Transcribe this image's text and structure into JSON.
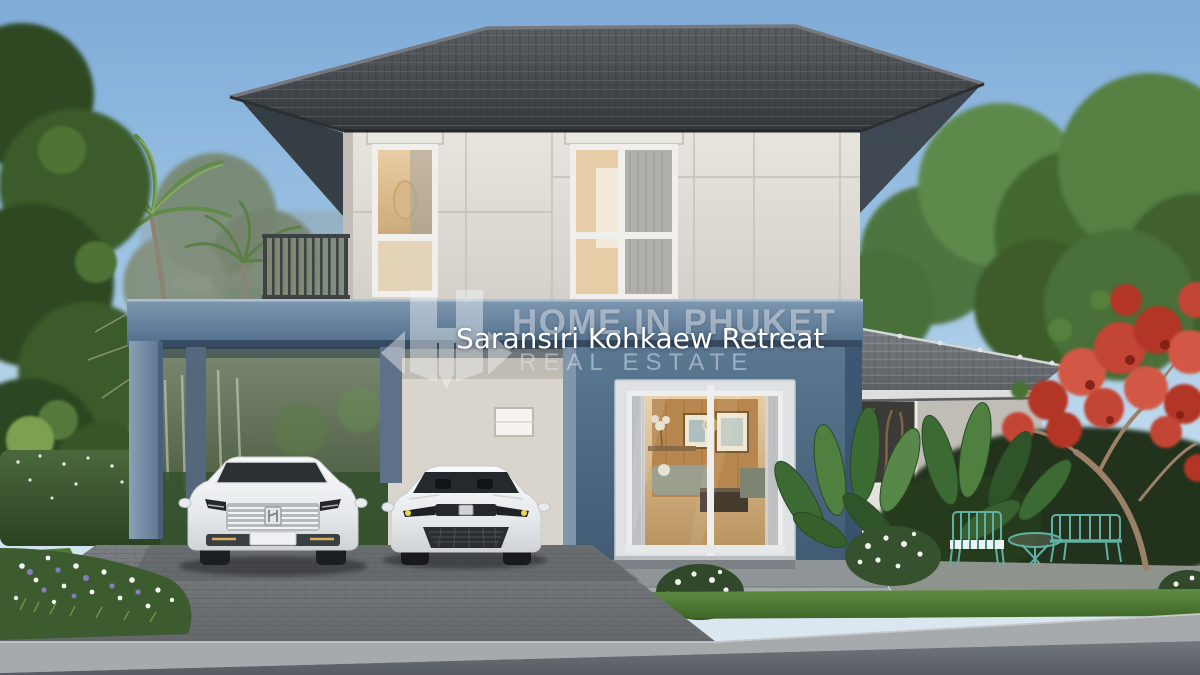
{
  "scene": {
    "type": "real-estate-architectural-render",
    "caption": "Saransiri Kohkaew Retreat",
    "watermark": {
      "logo_icon": "h-arrows-logo",
      "line1": "HOME IN PHUKET",
      "line2": "REAL ESTATE"
    },
    "palette": {
      "sky_top": "#7fabd8",
      "sky_horizon": "#dfe9f0",
      "roof_dark": "#3a3e42",
      "wing_roof_gray": "#6e7377",
      "wall_cream": "#d9d4cc",
      "accent_slate_blue": "#6d87a2",
      "living_wall_blue": "#4c6783",
      "glass_interior_warm": "#caa36f",
      "foliage_green": "#4a6b3a",
      "flame_tree_red": "#c2402f",
      "furniture_teal": "#5fb0a5",
      "driveway_gray": "#6e7275",
      "road_gray": "#676d73",
      "car_white": "#eef0f2"
    }
  }
}
